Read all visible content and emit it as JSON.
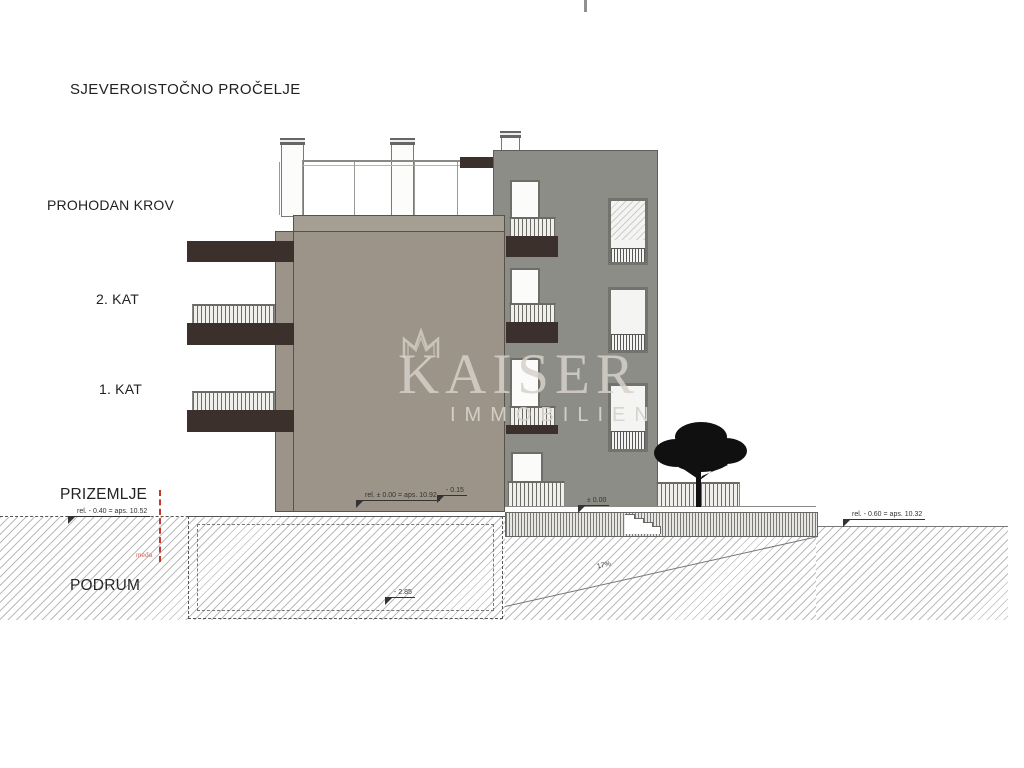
{
  "title": "SJEVEROISTOČNO PROČELJE",
  "floors": {
    "roof": "PROHODAN KROV",
    "second": "2. KAT",
    "first": "1. KAT",
    "ground": "PRIZEMLJE",
    "basement": "PODRUM"
  },
  "annotations": {
    "ground_left": "rel. - 0.40 = aps. 10.52",
    "zero_main": "rel. ± 0.00 = aps. 10.92",
    "entry": "- 0.15",
    "terrace": "± 0.00",
    "ground_right": "rel. - 0.60 = aps. 10.32",
    "basement_level": "- 2.85",
    "slope": "17%",
    "boundary": "međa"
  },
  "watermark": {
    "brand": "KAISER",
    "subtitle": "IMMOBILIEN"
  },
  "colors": {
    "facade": "#9c9489",
    "building_right": "#8d8d87",
    "balcony_slab": "#3b302b",
    "boundary_line": "#c0392b",
    "watermark": "#d6d1c9"
  }
}
